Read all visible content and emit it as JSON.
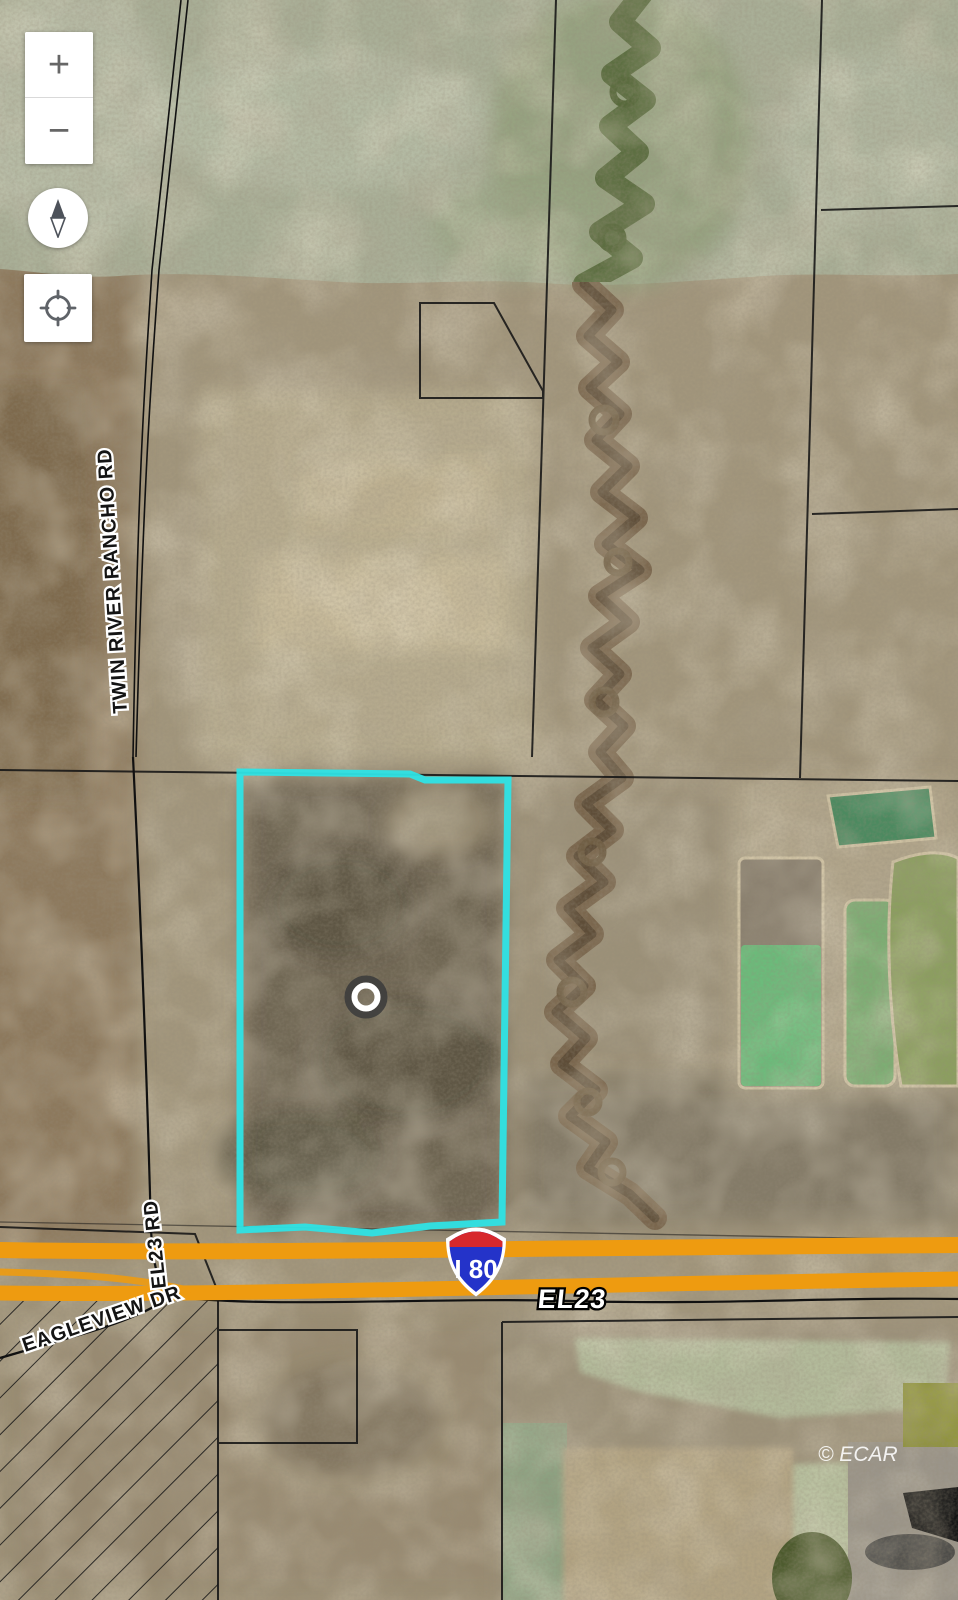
{
  "app": {
    "type": "satellite-parcel-map-viewer"
  },
  "controls": {
    "zoom_in_label": "+",
    "zoom_out_label": "−",
    "compass_icon": "compass-needle-icon",
    "locate_icon": "crosshair-icon"
  },
  "map": {
    "imagery": "aerial-satellite",
    "attribution": "© ECAR",
    "labels": {
      "twin_river_rancho_rd": "TWIN RIVER RANCHO RD",
      "el23_rd": "EL23 RD",
      "eagleview_dr": "EAGLEVIEW DR",
      "el23": "EL23"
    },
    "highway_shield": {
      "type": "interstate",
      "route": "I 80"
    },
    "subject_parcel": {
      "outline_color": "#2ee3e5",
      "marker": "ring-marker"
    },
    "colors": {
      "highway_orange": "#ee9b10",
      "shield_red": "#d7282d",
      "shield_blue": "#2433c9",
      "parcel_line": "#151515",
      "terrain_tan": "#a2967c",
      "terrain_green": "#a9af97",
      "pond_bright_green": "#6cbb7b",
      "pond_teal": "#4c8a60"
    }
  }
}
